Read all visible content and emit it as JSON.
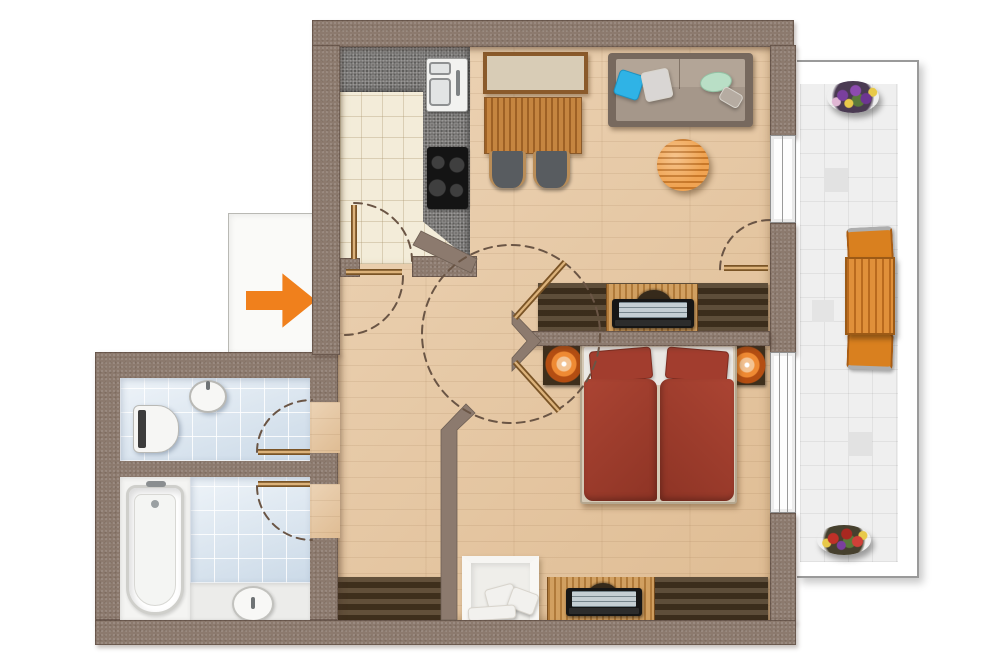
{
  "document": {
    "title": "Apartment floor plan - top view color render",
    "entrance_marker": "orange arrow pointing right into the flat"
  },
  "palette": {
    "wall": "#8c7a6e",
    "wood_floor": "#e6c59d",
    "kitchen_tile": "#f3ecd9",
    "bath_tile": "#dde8f2",
    "balcony_tile": "#efefef",
    "counter_gray": "#767472",
    "accent_orange": "#f0801c",
    "bed_red": "#9d3b2d",
    "dark_wood": "#4c3a24",
    "mid_wood": "#b5722e",
    "light_desk_wood": "#c28b47",
    "fixture_white": "#f4f4f2"
  },
  "rooms": {
    "kitchen": {
      "label": "Kitchen with L-shaped counter, double sink and cooktop"
    },
    "living_dining": {
      "label": "Living and dining room with sideboard, table, two chairs, sofa, coffee table and desk"
    },
    "bedroom": {
      "label": "Bedroom with double bed, two nightstands with lamps, armchair and desk"
    },
    "wc": {
      "label": "WC with toilet and washbasin"
    },
    "bathroom": {
      "label": "Bathroom with bathtub and washbasin"
    },
    "hallway": {
      "label": "Hallway with wardrobe"
    },
    "balcony": {
      "label": "Balcony with wooden table, two chairs and two flower planters"
    },
    "entrance": {
      "label": "Entrance with orange direction arrow"
    }
  },
  "furniture": {
    "kitchen": [
      "counter",
      "double-sink",
      "cooktop-4-burners"
    ],
    "living_dining": [
      "sideboard",
      "dining-table",
      "dining-chair",
      "dining-chair",
      "sofa-with-4-cushions",
      "round-coffee-table",
      "desk-with-laptop",
      "desk-chair"
    ],
    "bedroom": [
      "double-bed-red-duvets",
      "nightstand-left",
      "nightstand-right",
      "bedside-lamp-left",
      "bedside-lamp-right",
      "white-armchair-with-pillows",
      "desk-with-laptop",
      "wardrobe"
    ],
    "wc": [
      "toilet",
      "round-washbasin"
    ],
    "bathroom": [
      "bathtub",
      "round-washbasin",
      "vanity-counter"
    ],
    "hallway": [
      "wardrobe"
    ],
    "balcony": [
      "slatted-table",
      "chair",
      "chair",
      "flower-planter-purple",
      "flower-planter-red"
    ]
  },
  "doors": [
    "entrance-door-swing",
    "kitchen-door-swing",
    "bedroom-double-door-swing-circle",
    "balcony-door-swing",
    "wc-door-swing",
    "bathroom-door-swing"
  ]
}
